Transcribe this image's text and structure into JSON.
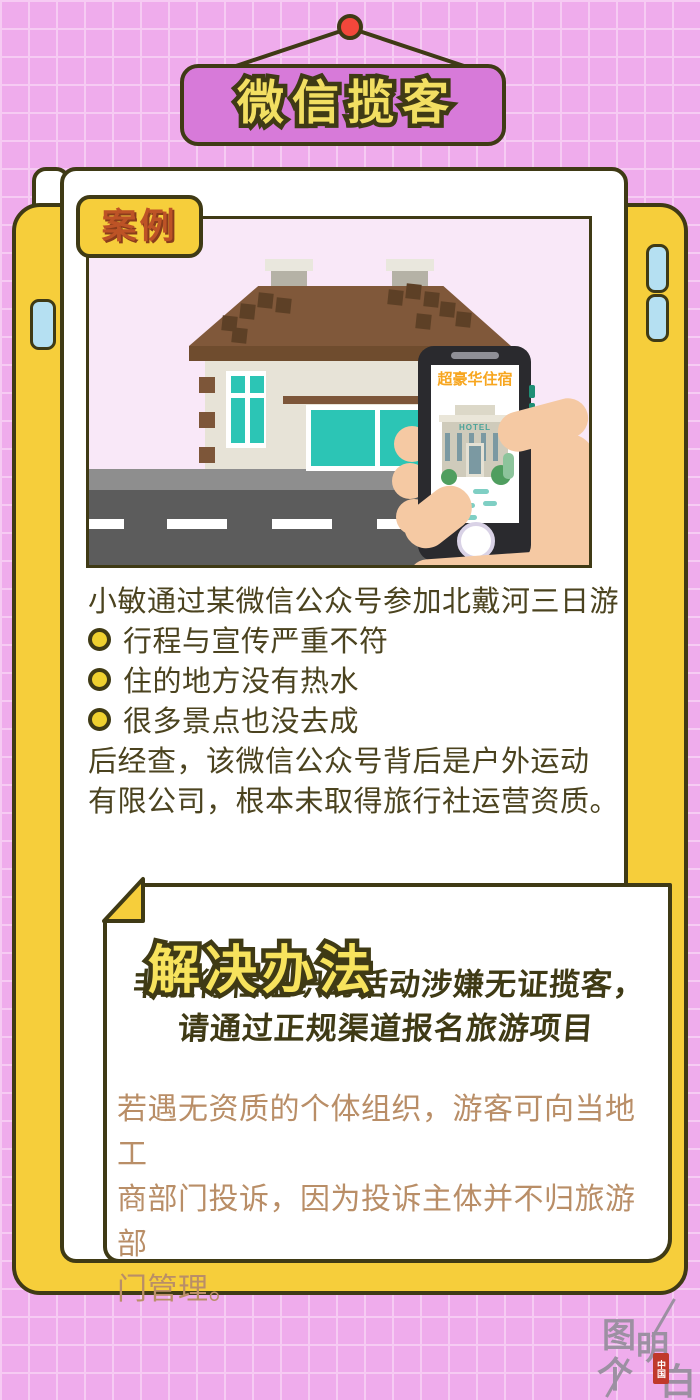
{
  "sign": {
    "title": "微信揽客"
  },
  "case": {
    "label": "案例",
    "intro": "小敏通过某微信公众号参加北戴河三日游",
    "bullets": [
      "行程与宣传严重不符",
      "住的地方没有热水",
      "很多景点也没去成"
    ],
    "conclusion_lines": [
      "后经查，该微信公众号背后是户外运动",
      "有限公司，根本未取得旅行社运营资质。"
    ],
    "illustration": {
      "phone_ad_headline": "超豪华住宿",
      "hotel_sign": "HOTEL"
    }
  },
  "solution": {
    "title": "解决办法",
    "warning_lines": [
      "非旅行社组织的活动涉嫌无证揽客，",
      "请通过正规渠道报名旅游项目"
    ],
    "body_lines": [
      "若遇无资质的个体组织，游客可向当地工",
      "商部门投诉，因为投诉主体并不归旅游部",
      "门管理。"
    ]
  },
  "logo": {
    "chars": [
      "图",
      "个",
      "明",
      "白"
    ],
    "seal_text": "中国"
  },
  "colors": {
    "background_pink": "#efacec",
    "grid_line": "#f6cbf3",
    "frame_yellow": "#f6ce3b",
    "sign_violet": "#d77ad9",
    "outline_dark": "#3f3a15",
    "label_orange": "#bd5326",
    "title_yellow": "#f2df62",
    "case_text": "#4b431f",
    "body_tan": "#b98e67",
    "window_teal": "#2cc5b5",
    "road_gray": "#5c5c5c",
    "hand_skin": "#f5c9a3",
    "phone_dark": "#2a2a2e",
    "ad_orange": "#f7a61f",
    "hanger_red": "#f3473b"
  }
}
